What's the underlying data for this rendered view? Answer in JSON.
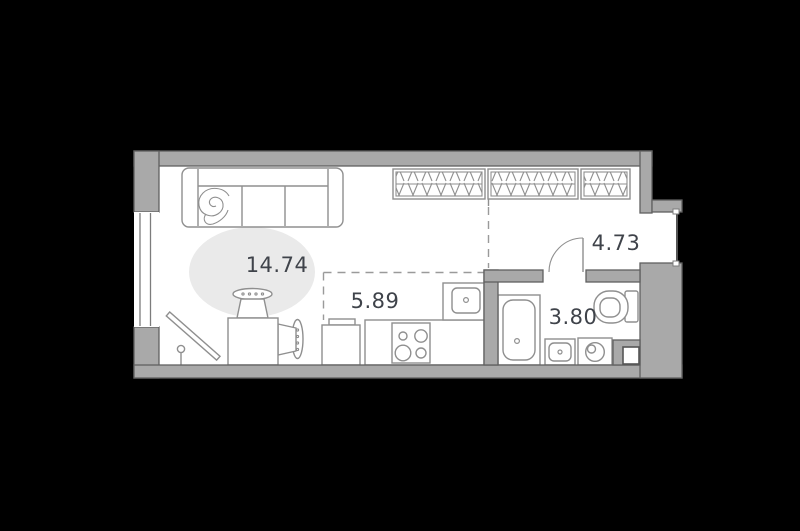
{
  "plan": {
    "rooms": {
      "living": {
        "area": "14.74"
      },
      "kitchen": {
        "area": "5.89"
      },
      "hallway": {
        "area": "4.73"
      },
      "bathroom": {
        "area": "3.80"
      }
    },
    "furniture": {
      "living": [
        "sofa",
        "round-rug",
        "dining-table",
        "chair",
        "chair",
        "tv-on-stand"
      ],
      "kitchen": [
        "fridge",
        "counter",
        "stove-4-burners",
        "kitchen-sink"
      ],
      "hallway": [
        "wardrobe",
        "wardrobe",
        "wardrobe"
      ],
      "bathroom": [
        "bathtub",
        "washbasin",
        "washing-machine",
        "toilet",
        "vent-shaft"
      ]
    },
    "openings": {
      "window": "left-wall-window",
      "entrance": "right-wall-entrance-opening",
      "bathroom_door": "swing-door-to-hallway"
    }
  },
  "colors": {
    "background": "#000000",
    "floor": "#ffffff",
    "wall_fill": "#a9a9a9",
    "wall_stroke": "#606060",
    "furniture_stroke": "#8f8f8f",
    "rug_fill": "#eaeaea",
    "label_text": "#3f434a",
    "zone_dash": "#9a9a9a"
  }
}
